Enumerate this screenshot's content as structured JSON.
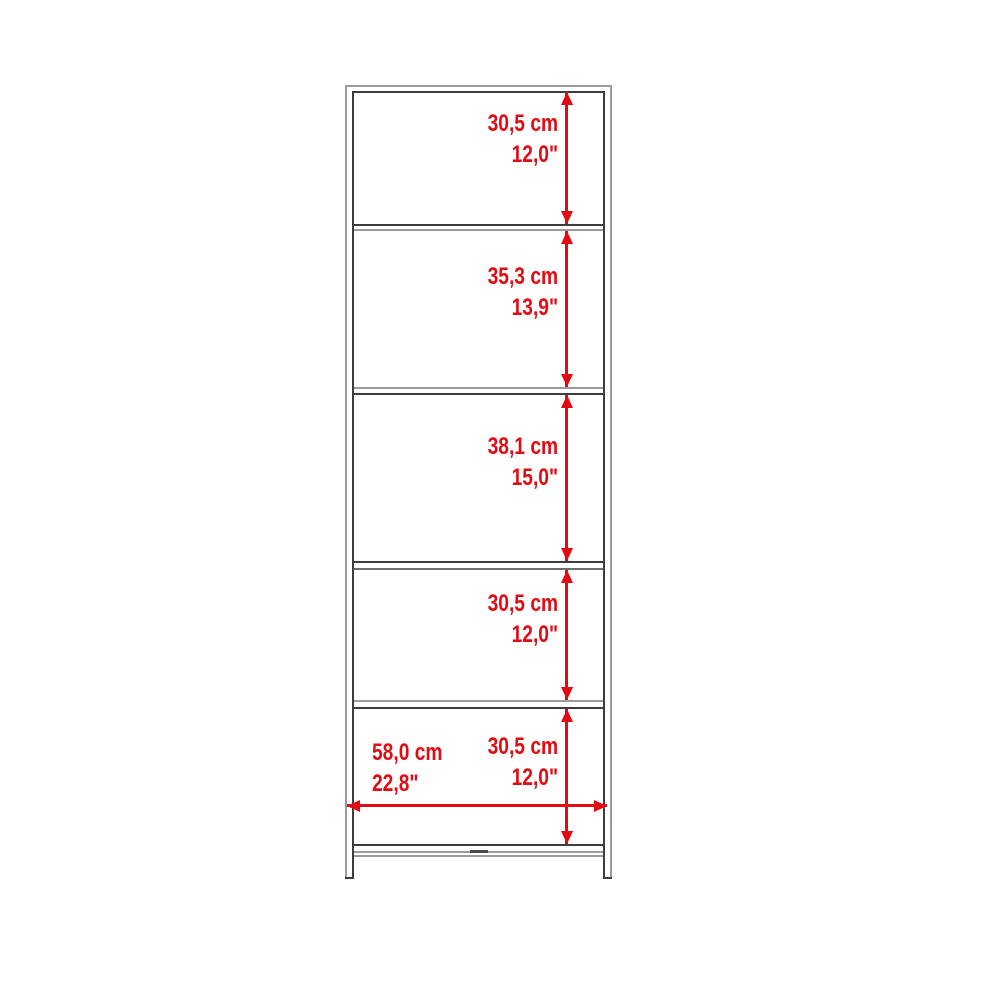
{
  "page": {
    "background": "#ffffff",
    "kind": "product-dimension-diagram",
    "subject": "5-tier open bookcase / shelf unit, front elevation with measurements"
  },
  "diagram": {
    "colors": {
      "dimension_red": "#e30b13",
      "frame_outer_gray": "#9b9b9b",
      "frame_inner_dark": "#3d3d3d"
    },
    "vertical_dimensions": [
      {
        "cm": "30,5 cm",
        "inches": "12,0\""
      },
      {
        "cm": "35,3 cm",
        "inches": "13,9\""
      },
      {
        "cm": "38,1 cm",
        "inches": "15,0\""
      },
      {
        "cm": "30,5 cm",
        "inches": "12,0\""
      },
      {
        "cm": "30,5 cm",
        "inches": "12,0\""
      }
    ],
    "horizontal_dimension": {
      "cm": "58,0 cm",
      "inches": "22,8\""
    }
  }
}
